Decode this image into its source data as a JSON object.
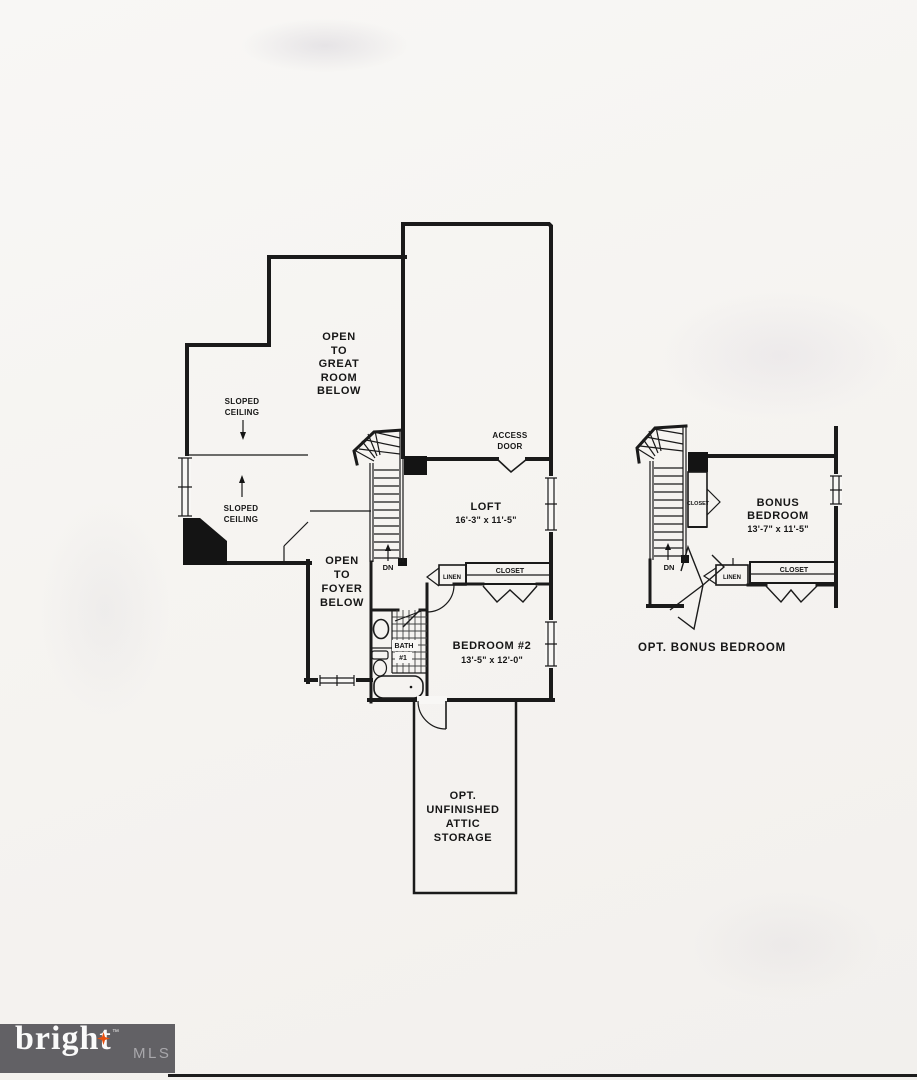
{
  "colors": {
    "ink": "#1a1a1a",
    "paper": "#f6f5f2",
    "logo_bg": "#626165",
    "logo_brand": "#fafafa",
    "logo_mls": "#a9a8ac",
    "logo_star": "#e8500f",
    "footer_rule": "#1c1c1c"
  },
  "main_plan": {
    "open_great_room": [
      "OPEN",
      "TO",
      "GREAT",
      "ROOM",
      "BELOW"
    ],
    "sloped_ceiling_upper": [
      "SLOPED",
      "CEILING"
    ],
    "sloped_ceiling_lower": [
      "SLOPED",
      "CEILING"
    ],
    "open_foyer": [
      "OPEN",
      "TO",
      "FOYER",
      "BELOW"
    ],
    "access_door": [
      "ACCESS",
      "DOOR"
    ],
    "loft_name": "LOFT",
    "loft_dims": "16'-3\" x 11'-5\"",
    "bedroom2_name": "BEDROOM #2",
    "bedroom2_dims": "13'-5\" x 12'-0\"",
    "bath_line1": "BATH",
    "bath_line2": "#1",
    "closet": "CLOSET",
    "linen": "LINEN",
    "down": "DN",
    "attic": [
      "OPT.",
      "UNFINISHED",
      "ATTIC",
      "STORAGE"
    ]
  },
  "bonus_plan": {
    "room_line1": "BONUS",
    "room_line2": "BEDROOM",
    "room_dims": "13'-7\" x 11'-5\"",
    "closet_side": "CLOSET",
    "closet_rear": "CLOSET",
    "linen": "LINEN",
    "down": "DN",
    "caption": "OPT. BONUS BEDROOM"
  },
  "footer": {
    "brand": "bright",
    "trademark": "™",
    "suffix": "MLS"
  }
}
